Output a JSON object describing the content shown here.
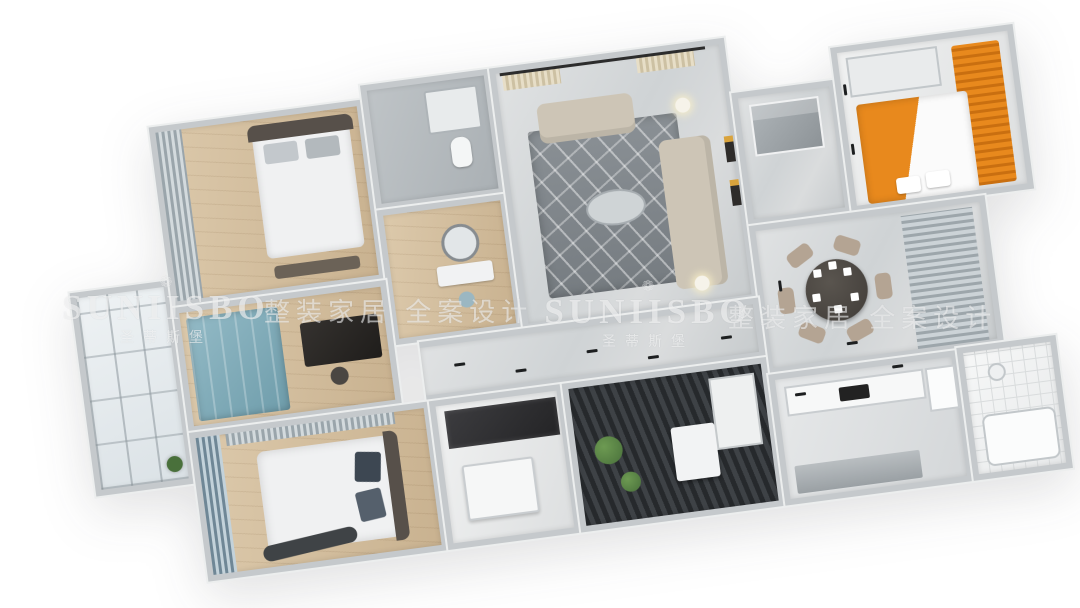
{
  "watermarks": {
    "ornament": "❁",
    "brand": "SUNIISBO",
    "brand_cn": "圣蒂斯堡",
    "slogan": "整装家居 全案设计"
  },
  "palette": {
    "wall": "#c5c9cc",
    "wallTop": "#eef0f1",
    "wood": "#dcc9ab",
    "woodDark": "#c9b290",
    "marble": "#d3d6d8",
    "rug": "#878d92",
    "sofa": "#cdc5b6",
    "bedWhite": "#f0f1f2",
    "headboard": "#57504a",
    "blue": "#93bac6",
    "blueDark": "#6f9dab",
    "orange": "#e8891d",
    "orangeDark": "#c96f10",
    "dark": "#3a3d40",
    "plant": "#49703b",
    "tileLine": "#d9dcdd"
  },
  "floorplan": {
    "type": "3d-isometric-apartment-render",
    "rotation_deg": -7.5,
    "rooms": [
      {
        "id": "balcony",
        "kind": "glazed balcony",
        "features": [
          "glass curtain wall",
          "plant"
        ]
      },
      {
        "id": "bedroom-2",
        "kind": "bedroom",
        "features": [
          "double bed with dark frame",
          "foot bench",
          "gray curtained window",
          "wood floor"
        ]
      },
      {
        "id": "bathroom-1",
        "kind": "bathroom",
        "features": [
          "glass shower",
          "toilet"
        ]
      },
      {
        "id": "dressing-area",
        "kind": "dressing area",
        "features": [
          "round mirror",
          "vanity table",
          "stool"
        ]
      },
      {
        "id": "living-room",
        "kind": "living room",
        "features": [
          "beige loveseat",
          "beige long sofa",
          "geometric gray rug",
          "oval coffee table",
          "floor lamps",
          "cream curtains",
          "wall art"
        ]
      },
      {
        "id": "foyer",
        "kind": "entry foyer",
        "features": [
          "glass display cabinet"
        ]
      },
      {
        "id": "kids-room",
        "kind": "kids bedroom / study",
        "features": [
          "orange tatami bed",
          "orange slatted wardrobe",
          "white desk"
        ]
      },
      {
        "id": "dining-room",
        "kind": "dining room",
        "features": [
          "round dark table",
          "six taupe chairs",
          "gray window blinds"
        ]
      },
      {
        "id": "hallway",
        "kind": "hallway",
        "features": [
          "marble floor"
        ]
      },
      {
        "id": "study",
        "kind": "study / guest room",
        "features": [
          "blue cabinet bed",
          "black desk"
        ]
      },
      {
        "id": "master-bedroom",
        "kind": "master bedroom",
        "features": [
          "king bed with white duvet",
          "patterned pillows",
          "blue striped curtains",
          "curved bench"
        ]
      },
      {
        "id": "desk-room",
        "kind": "study nook",
        "features": [
          "white desk unit",
          "dark glass wardrobe"
        ]
      },
      {
        "id": "laundry-balcony",
        "kind": "laundry balcony",
        "features": [
          "washing machine",
          "green plants",
          "dark deck floor",
          "white cabinet"
        ]
      },
      {
        "id": "kitchen",
        "kind": "kitchen",
        "features": [
          "L-shaped counter",
          "dark cooktop",
          "fridge"
        ]
      },
      {
        "id": "bathroom-2",
        "kind": "bathroom",
        "features": [
          "white grid tiles",
          "shower tray",
          "bathtub"
        ]
      }
    ]
  }
}
